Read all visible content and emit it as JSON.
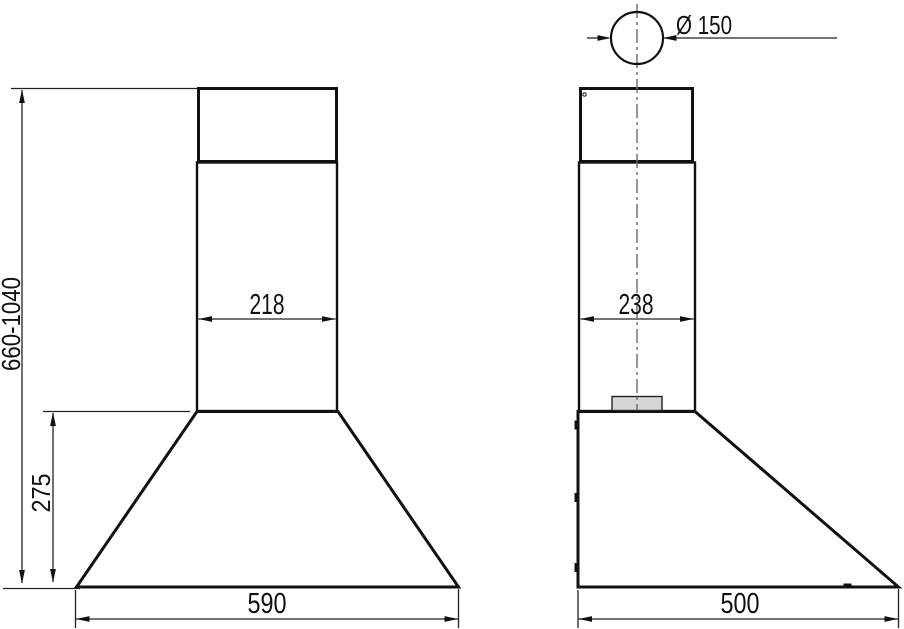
{
  "labels": {
    "height_range": "660-1040",
    "front_lower_height": "275",
    "front_chimney_width": "218",
    "front_body_width": "590",
    "duct_diameter": "Ø 150",
    "side_chimney_depth": "238",
    "side_body_depth": "500"
  },
  "colors": {
    "background": "#ffffff",
    "outline": "#111111",
    "dimension_line": "#222222",
    "centerline": "#6b6b6b",
    "panel_fill_top": "#f4f4f4",
    "panel_fill_bottom": "#cfcfcf",
    "hood_fill_bottom": "#e3e3e3"
  }
}
